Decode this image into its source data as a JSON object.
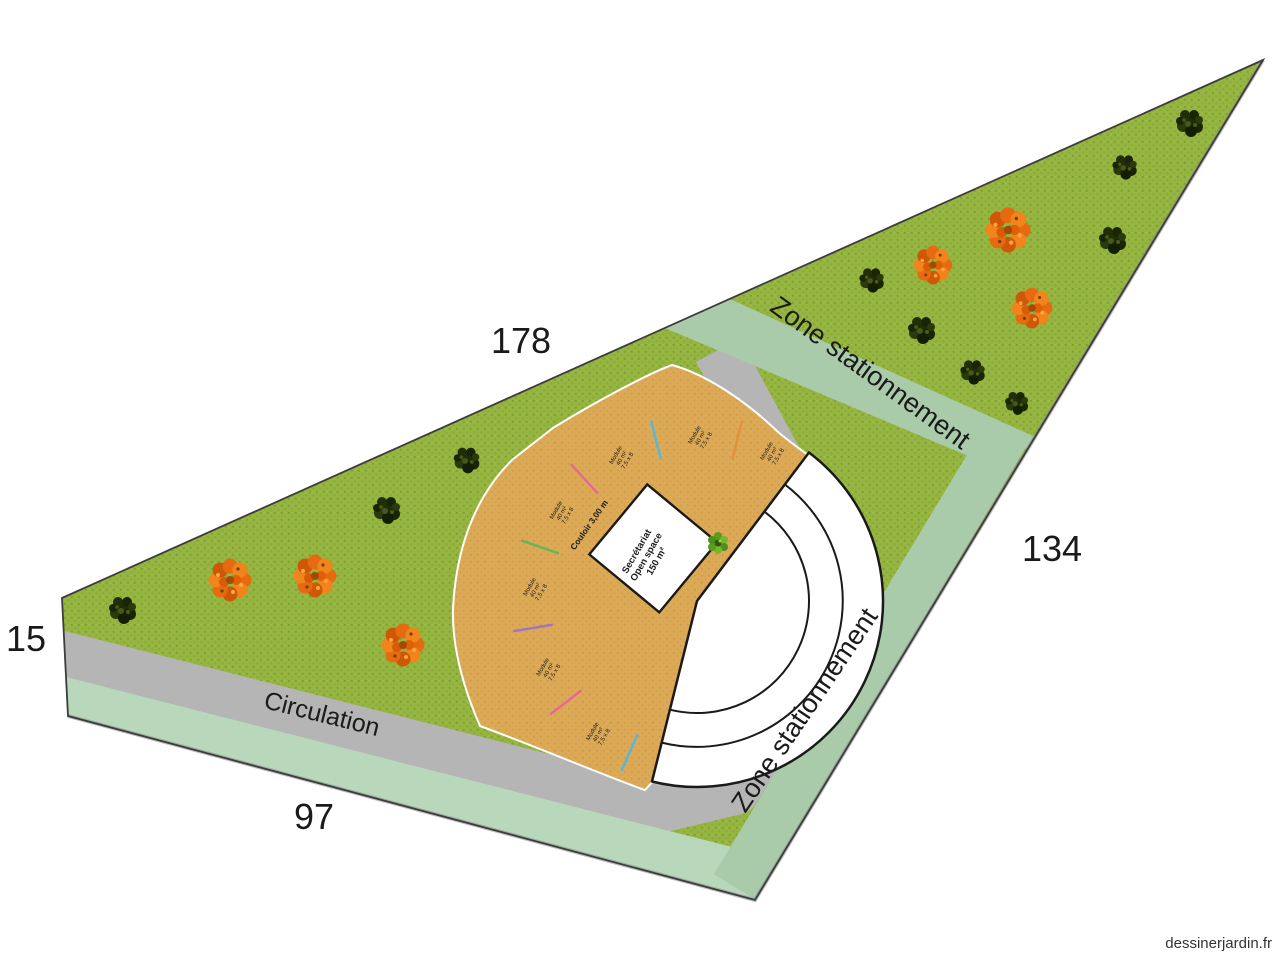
{
  "dimensions": {
    "top_edge": "178",
    "right_edge": "134",
    "left_edge": "15",
    "bottom_edge": "97"
  },
  "zones": {
    "parking_upper_label": "Zone stationnement",
    "parking_right_label": "Zone stationnement",
    "circulation_label": "Circulation"
  },
  "building": {
    "corridor_label": "Couloir 3,00 m",
    "open_space_lines": [
      "Secrétariat",
      "Open space",
      "150 m²"
    ],
    "module_label_lines": [
      "Module",
      "40 m²",
      "7,5 x 8"
    ],
    "module_count": 7
  },
  "vegetation": {
    "dark_bush_count": 10,
    "orange_tree_count": 6
  },
  "palette": {
    "grass": "#96b440",
    "grass_dot": "#7ca133",
    "sand": "#dcaa57",
    "sand_dot": "#d09b46",
    "circulation_gray": "#b5b5b5",
    "parking_green": "#a9cbaa",
    "outline": "#3c3c3c",
    "building_white": "#ffffff"
  },
  "watermark": "dessinerjardin.fr"
}
